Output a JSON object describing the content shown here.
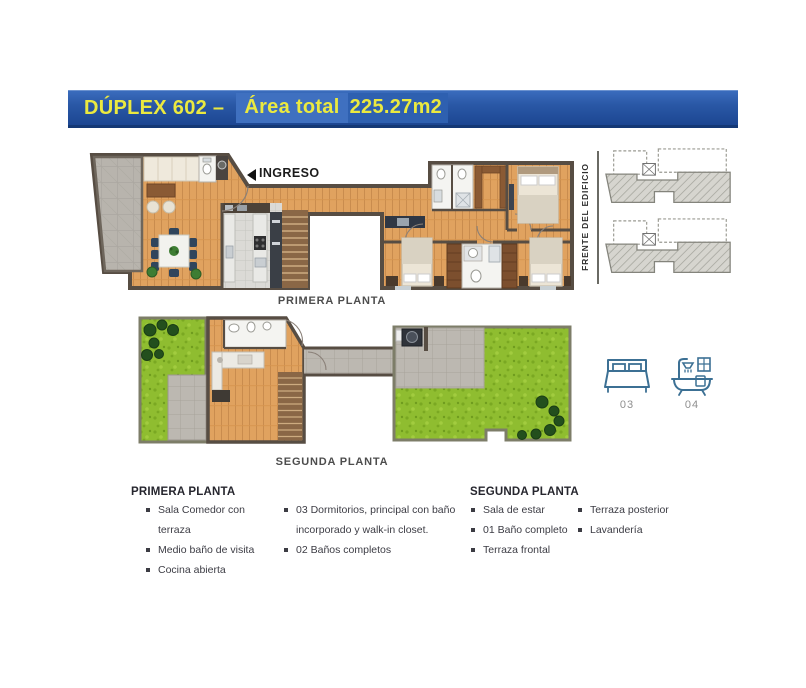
{
  "header": {
    "title_prefix": "DÚPLEX 602 –",
    "area_label": "Área total",
    "area_value": "225.27m2"
  },
  "plan_primera": {
    "caption": "PRIMERA PLANTA",
    "entrance_label": "INGRESO"
  },
  "plan_segunda": {
    "caption": "SEGUNDA PLANTA"
  },
  "side_panel": {
    "front_label": "FRENTE DEL EDIFICIO"
  },
  "stats": {
    "bedrooms": {
      "icon": "bed-icon",
      "count": "03"
    },
    "bathrooms": {
      "icon": "bathtub-icon",
      "count": "04"
    }
  },
  "features": {
    "primera": {
      "heading": "PRIMERA PLANTA",
      "col1": [
        "Sala Comedor con terraza",
        "Medio baño de visita",
        "Cocina abierta"
      ],
      "col2": [
        "03 Dormitorios, principal con baño incorporado y walk-in closet.",
        "02 Baños completos"
      ]
    },
    "segunda": {
      "heading": "SEGUNDA PLANTA",
      "col1": [
        "Sala de estar",
        "01 Baño completo",
        "Terraza frontal"
      ],
      "col2": [
        "Terraza posterior",
        "Lavandería"
      ]
    }
  },
  "palette": {
    "header_blue_top": "#3a6cbd",
    "header_blue_bottom": "#1c4692",
    "header_text_yellow": "#ebe93f",
    "wood_floor": "#e0a25f",
    "terrace_stone": "#b8b4ad",
    "grass_green": "#8fbd30",
    "wall_dark": "#574d43",
    "icon_blue": "#3c7094",
    "text_dark": "#3c3c44"
  }
}
